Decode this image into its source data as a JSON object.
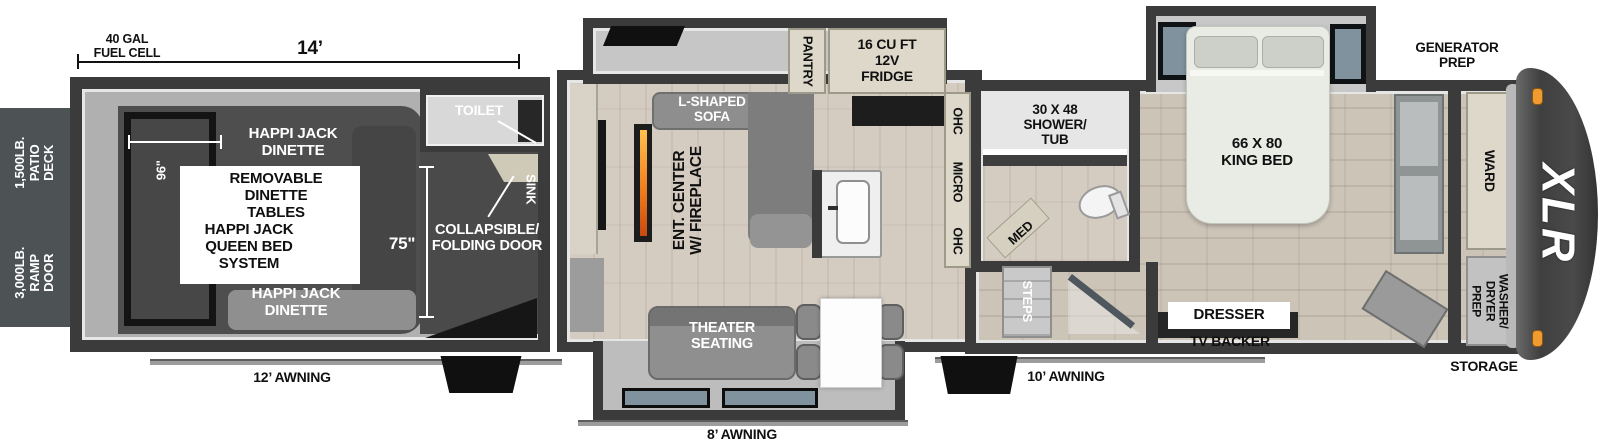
{
  "exterior": {
    "patio_deck": "1,500LB.\nPATIO DECK",
    "ramp_door": "3,000LB.\nRAMP DOOR",
    "fuel_cell": "40 GAL\nFUEL CELL",
    "awning_rear": "12’ AWNING",
    "awning_mid": "8’ AWNING",
    "awning_front": "10’ AWNING",
    "generator_prep": "GENERATOR\nPREP",
    "storage": "STORAGE",
    "logo": "XLR"
  },
  "dimensions": {
    "garage_length": "14’",
    "garage_opening": "96\"",
    "garage_door_height": "75\""
  },
  "garage": {
    "dinette_top": "HAPPI JACK\nDINETTE",
    "dinette_tables": "REMOVABLE\nDINETTE\nTABLES",
    "queen_bed": "HAPPI JACK\nQUEEN BED\nSYSTEM",
    "dinette_bottom": "HAPPI JACK\nDINETTE",
    "toilet": "TOILET",
    "sink": "SINK",
    "folding_door": "COLLAPSIBLE/\nFOLDING DOOR"
  },
  "living": {
    "pantry": "PANTRY",
    "fridge": "16 CU FT\n12V\nFRIDGE",
    "sofa": "L-SHAPED\nSOFA",
    "ent_center": "ENT. CENTER\nW/ FIREPLACE",
    "ohc_top": "OHC",
    "micro": "MICRO",
    "ohc_bottom": "OHC",
    "theater": "THEATER\nSEATING"
  },
  "bath": {
    "shower": "30 X 48\nSHOWER/\nTUB",
    "med": "MED",
    "steps": "STEPS"
  },
  "bedroom": {
    "king_bed": "66 X 80\nKING BED",
    "dresser": "DRESSER",
    "tv_backer": "TV BACKER"
  },
  "front": {
    "ward": "WARD",
    "washer_dryer": "WASHER/\nDRYER\nPREP"
  },
  "colors": {
    "wall": "#3b3b3b",
    "flame": "#f07f1f",
    "marker_light": "#f09a30"
  }
}
